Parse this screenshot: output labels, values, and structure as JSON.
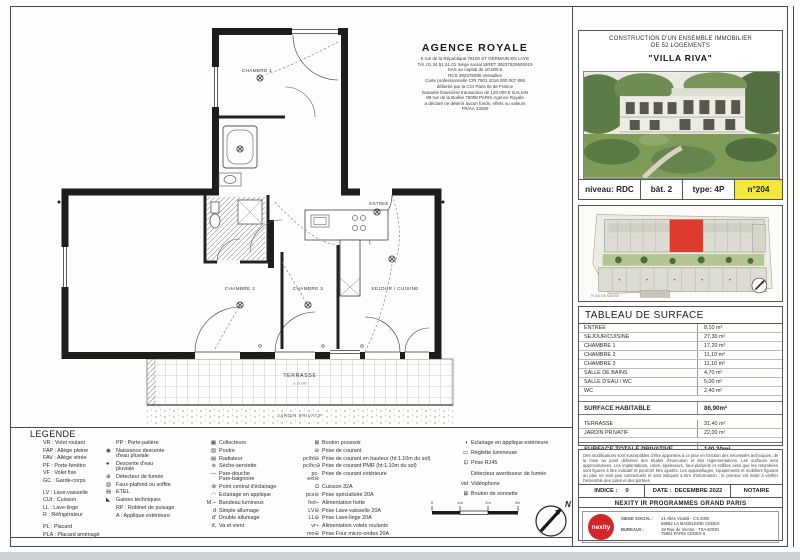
{
  "colors": {
    "highlight_yellow": "#f2e93c",
    "nexity_red": "#d0262b",
    "unit_red": "#df3a2e"
  },
  "agency": {
    "name": "AGENCE ROYALE",
    "lines": [
      "5 rue de la République 78100 ST GERMAIN EN LAYE",
      "Tél. 01.34.51.51.01 Siège social SIRET 39237829500019",
      "SAS au capital de 10.000 €",
      "RCS 392378295 Versailles",
      "Carte professionnelle CPI 7801 2016 000 007 898",
      "délivrée par la CCI Paris Ile de France",
      "Garantie financière transaction de 120.000 € GALIAN",
      "89 rue de la Boétie 75008 PARIS Agence Royale",
      "a déclaré ne détenir aucun fonds, effets ou valeurs",
      "FR/AA 13280"
    ]
  },
  "project": {
    "title_line1": "CONSTRUCTION D'UN ENSEMBLE IMMOBILIER",
    "title_line2": "DE 52 LOGEMENTS",
    "name": "\"VILLA RIVA\"",
    "niveau": "niveau: RDC",
    "bat": "bât. 2",
    "type": "type: 4P",
    "num": "n°204"
  },
  "site": {
    "caption": "PLAN DE MASSE"
  },
  "plan": {
    "chambre1": "CHAMBRE 1",
    "chambre2": "CHAMBRE 2",
    "chambre3": "CHAMBRE 3",
    "sejour": "SEJOUR / CUISINE",
    "entree": "ENTREE",
    "terrasse": "TERRASSE",
    "terrasse_level": "± 0.00",
    "jardin": "JARDIN PRIVATIF"
  },
  "surface_table": {
    "title": "TABLEAU DE SURFACE",
    "main_rows": [
      {
        "label": "ENTREE",
        "value": "8,10 m²"
      },
      {
        "label": "SEJOUR/CUISINE",
        "value": "27,30 m²"
      },
      {
        "label": "CHAMBRE 1",
        "value": "17,20 m²"
      },
      {
        "label": "CHAMBRE 2",
        "value": "11,10 m²"
      },
      {
        "label": "CHAMBRE 3",
        "value": "11,10 m²"
      },
      {
        "label": "SALLE DE BAINS",
        "value": "4,70 m²"
      },
      {
        "label": "SALLE D'EAU / WC",
        "value": "5,00 m²"
      },
      {
        "label": "WC",
        "value": "2,40 m²"
      }
    ],
    "habitable": {
      "label": "SURFACE HABITABLE",
      "value": "86,90m²"
    },
    "outdoor_rows": [
      {
        "label": "TERRASSE",
        "value": "31,40 m²"
      },
      {
        "label": "JARDIN PRIVATIF",
        "value": "22,00 m²"
      }
    ],
    "total": {
      "label": "SURFACE TOTALE PRIVATIVE",
      "value": "140,30m²"
    }
  },
  "legend": {
    "title": "LEGENDE",
    "col1": [
      "VR : Volet roulant",
      "FAP : Allège pleine",
      "FAV : Allège vitrée",
      "PF : Porte-fenêtre",
      "VF : Volet fixe",
      "GC : Garde-corps",
      "",
      "LV : Lave-vaisselle",
      "CUI : Cuisson",
      "LL : Lave-linge",
      "R : Réfrigérateur",
      "",
      "PL : Placard",
      "PLA : Placard aménagé"
    ],
    "col2": [
      {
        "sym": "",
        "label": "PP : Porte-palière"
      },
      {
        "sym": "◉",
        "label": "Naissance descente\nd'eau pluviale"
      },
      {
        "sym": "●",
        "label": "Descente d'eau\npluviale"
      },
      {
        "sym": "⊕",
        "label": "Détecteur de fumée"
      },
      {
        "sym": "▨",
        "label": "Faux-plafond ou soffite"
      },
      {
        "sym": "▤",
        "label": "ETEL"
      },
      {
        "sym": "◣",
        "label": "Gaines techniques"
      },
      {
        "sym": "",
        "label": "RP : Robinet de puisage"
      },
      {
        "sym": "",
        "label": "A : Applique extérieure"
      }
    ],
    "col3": [
      {
        "sym": "▦",
        "label": "Collecteurs"
      },
      {
        "sym": "▨",
        "label": "Poutre"
      },
      {
        "sym": "▤",
        "label": "Radiateur"
      },
      {
        "sym": "≋",
        "label": "Sèche-serviette"
      },
      {
        "sym": "—",
        "label": "Pare-douche\nPare-baignoire"
      },
      {
        "sym": "⊗",
        "label": "Point central d'éclairage"
      },
      {
        "sym": "◠",
        "label": "Eclairage en applique"
      },
      {
        "sym": "M.⌁",
        "label": "Bandeau lumineux"
      },
      {
        "sym": "đ",
        "label": "Simple allumage"
      },
      {
        "sym": "đ'",
        "label": "Double allumage"
      },
      {
        "sym": "đ,",
        "label": "Va et vient"
      }
    ],
    "col4": [
      {
        "sym": "⊠",
        "label": "Bouton poussoir"
      },
      {
        "sym": "⊖",
        "label": "Prise de courant"
      },
      {
        "sym": "pc/ht⊖",
        "label": "Prise de courant en hauteur (ht:1.10m du sol)"
      },
      {
        "sym": "pc/hc⊖",
        "label": "Prise de courant PMR (ht:1.10m du sol)"
      },
      {
        "sym": "pc-ext⊖",
        "label": "Prise de courant extérieure"
      },
      {
        "sym": "Ω",
        "label": "Cuisson 32A"
      },
      {
        "sym": "pcs⊖",
        "label": "Prise spécialisée 20A"
      },
      {
        "sym": "hot⌁",
        "label": "Alimentation hotte"
      },
      {
        "sym": "LV⊖",
        "label": "Prise Lave-vaisselle 20A"
      },
      {
        "sym": "LL⊖",
        "label": "Prise Lave-linge 20A"
      },
      {
        "sym": "vr⌁",
        "label": "Alimentation volets roulants"
      },
      {
        "sym": "mo⊖",
        "label": "Prise Four micro-ondes 20A"
      }
    ],
    "col5": [
      {
        "sym": "◖",
        "label": "Eclairage en applique extérieure"
      },
      {
        "sym": "▭",
        "label": "Réglette lumineuse"
      },
      {
        "sym": "⊡",
        "label": "Prise RJ45"
      },
      {
        "sym": "",
        "label": "Détecteur avertisseur de fumée"
      },
      {
        "sym": "vid",
        "label": "Vidéophone"
      },
      {
        "sym": "⊠",
        "label": "Bouton de sonnette"
      }
    ]
  },
  "scale": {
    "t0": "0",
    "t1": "1m",
    "t2": "2m",
    "t3": "5m"
  },
  "compass": {
    "label": "N"
  },
  "footer": {
    "disclaimer": "Des modifications sont susceptibles d'être apportées à ce plan en fonction des nécessités techniques, de la mise au point définitive des études d'exécution et des réglementations. Les surfaces sont approximatives. Les implantations, cotes, épaisseurs, faux-plafonds et soffites ainsi que les retombées sont figurés à titre indicatif et pourront être ajustés. Les appareillages, équipements et mobiliers figurant au plan ne sont pas contractuels et sont indiqués à titre d'information ; le preneur est invité à vérifier l'ensemble des cotes et des portées.",
    "indice_label": "INDICE :",
    "indice_value": "0",
    "date_label": "DATE :",
    "date_value": "DECEMBRE 2022",
    "notaire": "NOTAIRE",
    "company": "NEXITY IR PROGRAMMES GRAND PARIS",
    "logo_text": "nexity",
    "siege_label": "SIEGE SOCIAL :",
    "siege_value": "21 Allée Vivaldi - CS 2000\n59562 LA MADELEINE CEDEX",
    "bureaux_label": "BUREAUX :",
    "bureaux_value": "19 Rue de Vienne - TSA 60030\n75801 PARIS CEDEX 8"
  }
}
